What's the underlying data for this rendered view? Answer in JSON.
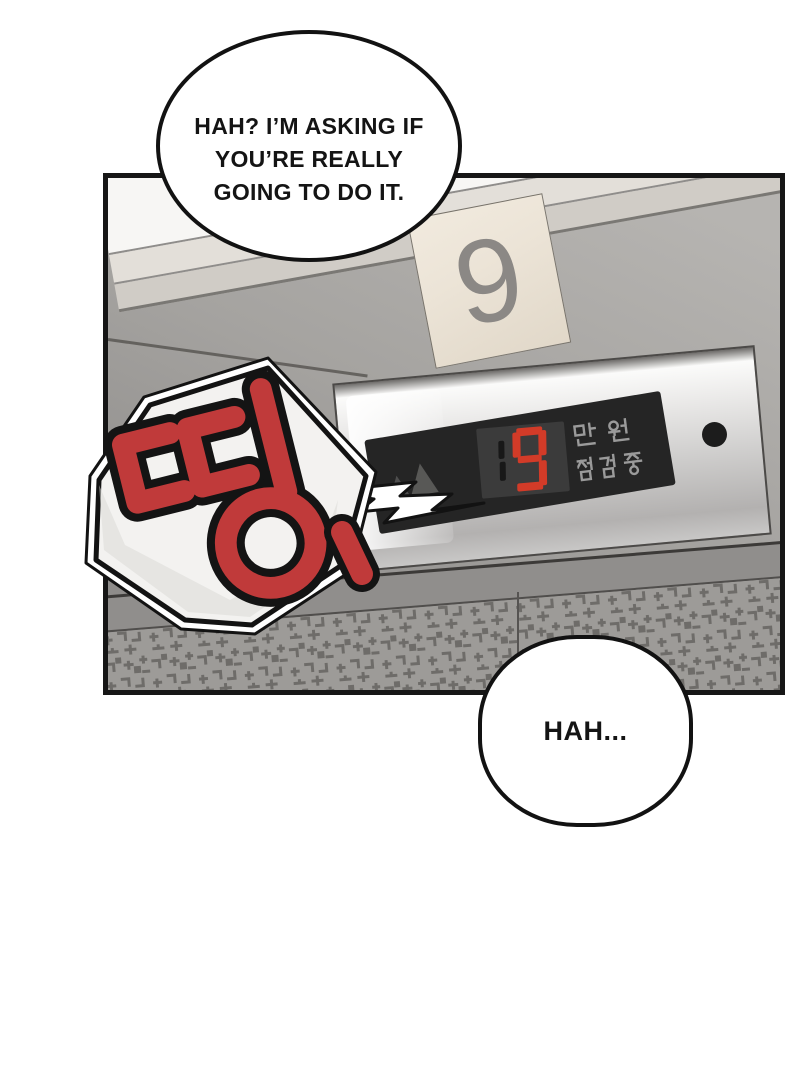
{
  "page": {
    "background": "#ffffff",
    "type": "webtoon-comic-panel"
  },
  "speech_bubbles": {
    "top": {
      "lines": [
        "HAH? I’M ASKING IF",
        "YOU’RE REALLY",
        "GOING TO DO IT."
      ],
      "full_text": "HAH? I’M ASKING IF YOU’RE REALLY GOING TO DO IT."
    },
    "bottom": {
      "text": "HAH..."
    }
  },
  "panel": {
    "floor_sign": {
      "number": "9",
      "bg_color": "#ece4d7",
      "digit_color": "#8b8885"
    },
    "elevator_display": {
      "dim_digit": "1",
      "lit_digit": "9",
      "value_shown": "19",
      "lit_color": "#d23b28",
      "dim_color": "#181818",
      "display_bg": "#252525",
      "indicator_labels": [
        "만 원",
        "점검중"
      ],
      "label_color": "#9a9a9a"
    },
    "sfx": {
      "text": "띵!",
      "color": "#c03a3a",
      "outline_color": "#141414",
      "bubble_shape": "hexagon-burst",
      "bubble_fill": "#f3f2f0"
    },
    "colors": {
      "wall_light": "#b6b4b1",
      "wall_dark": "#898785",
      "plate_silver": "#ecebea",
      "tile_bg": "#9d9b98",
      "tile_pattern": "#6e6c69",
      "panel_border": "#161616"
    }
  }
}
